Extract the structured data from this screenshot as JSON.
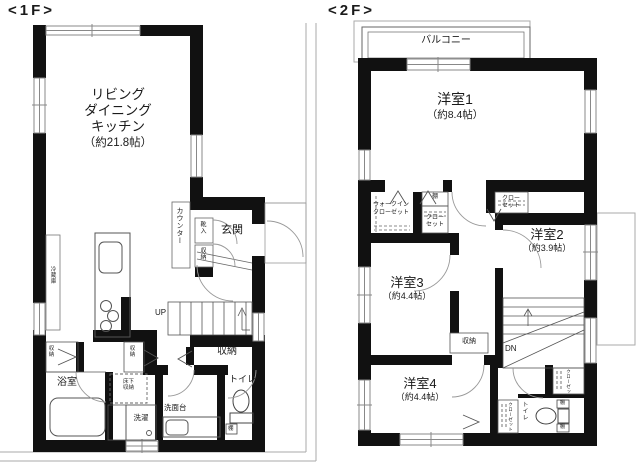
{
  "f1": {
    "title": "<1F>",
    "ldk1": "リビング",
    "ldk2": "ダイニング",
    "ldk3": "キッチン",
    "ldk_size": "（約21.8帖）",
    "counter": "カウンター",
    "shoe_box": "靴入",
    "shoe_storage": "収納",
    "entrance": "玄関",
    "refrigerator": "冷蔵庫",
    "up": "UP",
    "hall_storage": "収納",
    "closet_a": "収納",
    "closet_b": "収納",
    "bath": "浴室",
    "underfloor_storage": "床下収納",
    "laundry": "洗濯",
    "vanity": "洗面台",
    "toilet": "トイレ",
    "shelf": "棚"
  },
  "f2": {
    "title": "<2F>",
    "balcony": "バルコニー",
    "room1": "洋室1",
    "room1_size": "（約8.4帖）",
    "wic1": "ウォークイン",
    "wic2": "クローゼット",
    "shelf_top": "棚",
    "closet_a1": "クロー",
    "closet_a2": "セット",
    "closet_b1": "クロー",
    "closet_b2": "セット",
    "room2": "洋室2",
    "room2_size": "（約3.9帖）",
    "room3": "洋室3",
    "room3_size": "（約4.4帖）",
    "storage": "収納",
    "dn": "DN",
    "room4": "洋室4",
    "room4_size": "（約4.4帖）",
    "closet_c": "クローゼット",
    "closet_d": "クローゼット",
    "toilet": "トイレ",
    "shelf_a": "棚",
    "shelf_b": "棚"
  },
  "colors": {
    "wall": "#111111",
    "line": "#555555",
    "boundary": "#aaaaaa"
  }
}
